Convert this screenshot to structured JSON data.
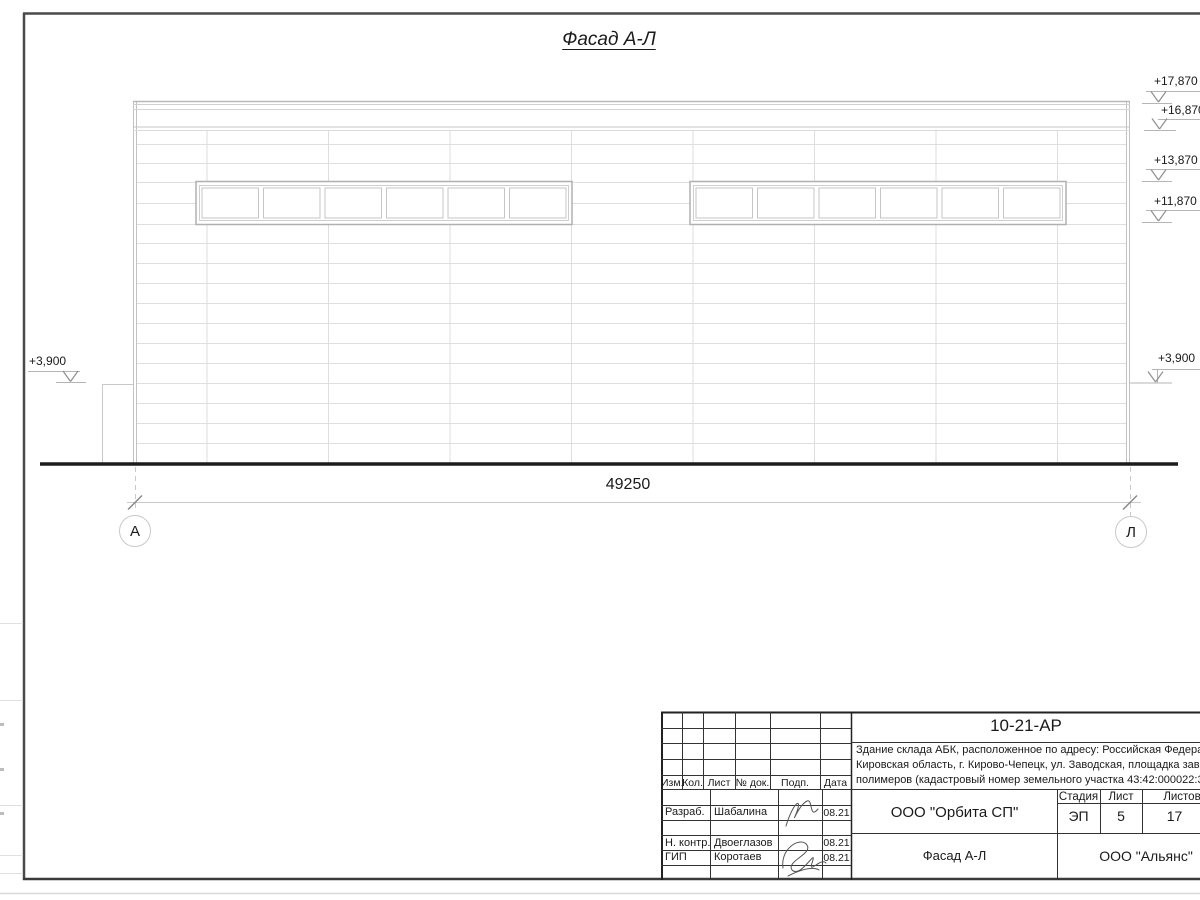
{
  "colors": {
    "ink": "#1a1a1a",
    "line_light": "#dedede",
    "frame": "#4a4a4a"
  },
  "drawing": {
    "title": "Фасад А-Л",
    "dimension_total": "49250",
    "axis_left": "А",
    "axis_right": "Л",
    "elevations": {
      "top1": "+17,870",
      "top2": "+16,870",
      "mid1": "+13,870",
      "mid2": "+11,870",
      "base_left": "+3,900",
      "base_right": "+3,900"
    }
  },
  "title_block": {
    "doc_number": "10-21-АР",
    "description": {
      "line1": "Здание склада АБК, расположенное по адресу: Российская Федерация,",
      "line2": "Кировская область, г. Кирово-Чепецк, ул. Заводская, площадка завода",
      "line3": "полимеров (кадастровый номер земельного участка 43:42:000022:3"
    },
    "columns": {
      "c1": "Изм.",
      "c2": "Кол.",
      "c3": "Лист",
      "c4": "№ док.",
      "c5": "Подп.",
      "c6": "Дата"
    },
    "staff": [
      {
        "role": "Разраб.",
        "name": "Шабалина",
        "date": "08.21"
      },
      {
        "role": "Н. контр.",
        "name": "Двоеглазов",
        "date": "08.21"
      },
      {
        "role": "ГИП",
        "name": "Коротаев",
        "date": "08.21"
      }
    ],
    "company": "ООО \"Орбита СП\"",
    "drawing_name": "Фасад А-Л",
    "contractor": "ООО \"Альянс\"",
    "stage_label": "Стадия",
    "sheet_label": "Лист",
    "sheets_label": "Листов",
    "stage": "ЭП",
    "sheet_number": "5",
    "sheets_total": "17"
  }
}
